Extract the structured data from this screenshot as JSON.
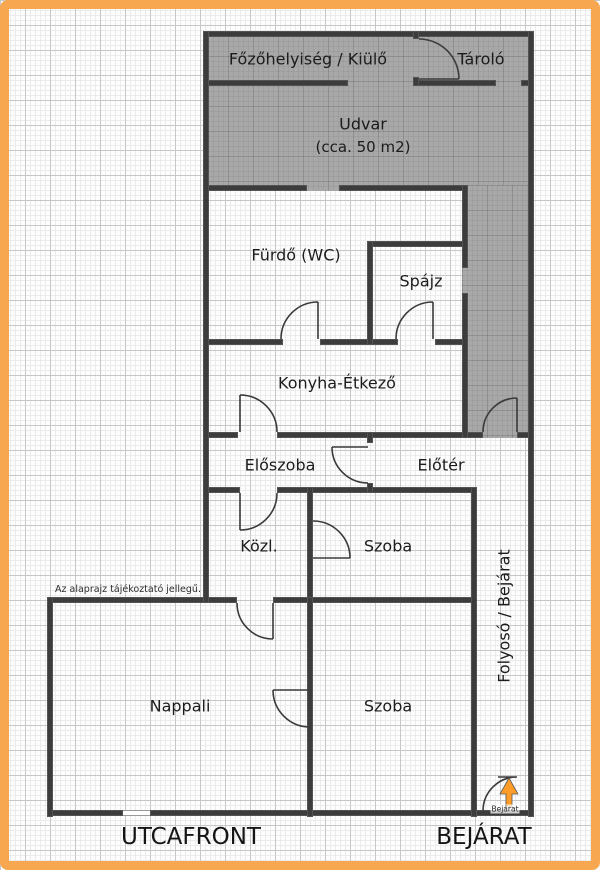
{
  "plan": {
    "rooms": [
      {
        "id": "fozohelyiseg",
        "label": "Főzőhelyiség / Kiülő"
      },
      {
        "id": "tarolo",
        "label": "Tároló"
      },
      {
        "id": "udvar",
        "label": "Udvar",
        "sublabel": "(cca. 50 m2)"
      },
      {
        "id": "furdo",
        "label": "Fürdő (WC)"
      },
      {
        "id": "spajz",
        "label": "Spájz"
      },
      {
        "id": "konyha-etkezo",
        "label": "Konyha-Étkező"
      },
      {
        "id": "eloszoba",
        "label": "Előszoba"
      },
      {
        "id": "eloter",
        "label": "Előtér"
      },
      {
        "id": "kozlekedo",
        "label": "Közl."
      },
      {
        "id": "szoba-felso",
        "label": "Szoba"
      },
      {
        "id": "nappali",
        "label": "Nappali"
      },
      {
        "id": "szoba-also",
        "label": "Szoba"
      },
      {
        "id": "folyoso",
        "label": "Folyosó / Bejárat"
      }
    ],
    "disclaimer": "Az alaprajz tájékoztató jellegű.",
    "entrance_label": "Bejárat",
    "footer": {
      "left": "UTCAFRONT",
      "right": "BEJÁRAT"
    }
  },
  "colors": {
    "frame": "#f7a750",
    "wall": "#3c3c3c",
    "courtyard_fill": "#a8a8a8",
    "entrance_arrow": "#ff9c27"
  }
}
